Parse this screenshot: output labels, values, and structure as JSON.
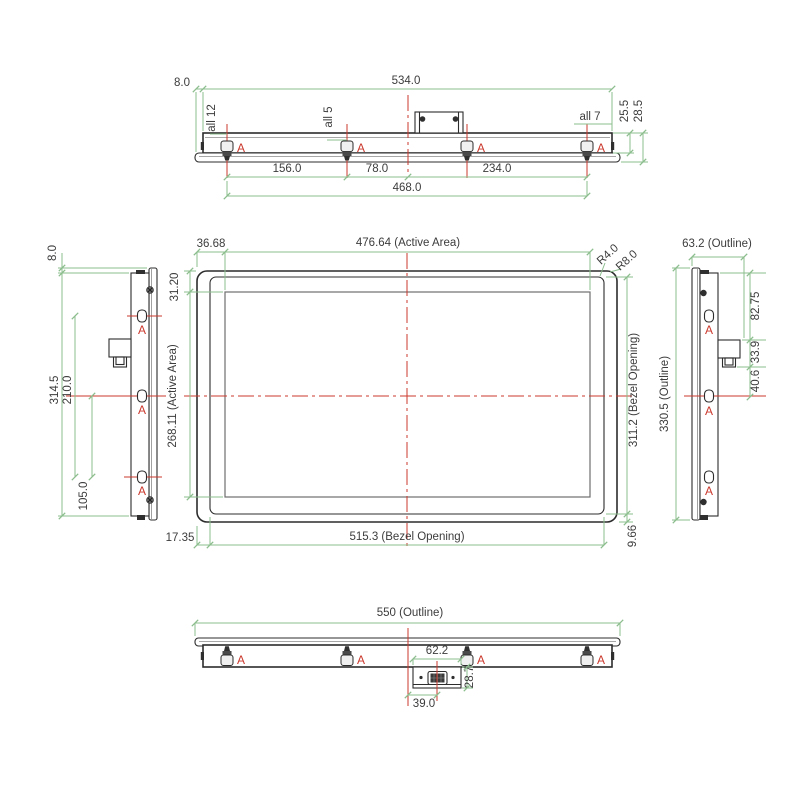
{
  "title": "Panel mechanical dimension drawing",
  "units": "mm",
  "datum": "A",
  "colors": {
    "dimension_line": "#8bbd8d",
    "centerline_and_datum": "#cb382c",
    "outline": "#2c2c2c",
    "active_area_line": "#6f6f6f",
    "background": "#ffffff"
  },
  "views": {
    "top": {
      "offset": "8.0",
      "overall": "534.0",
      "holes_left": "all 12",
      "holes_mid": "all 5",
      "holes_right": "all 7",
      "depth_inner": "25.5",
      "depth_outer": "28.5",
      "pitch_1": "156.0",
      "pitch_2": "78.0",
      "pitch_3": "234.0",
      "pitch_total": "468.0"
    },
    "left": {
      "offset": "8.0",
      "overall": "314.5",
      "pitch_upper": "210.0",
      "pitch_lower": "105.0"
    },
    "front": {
      "margin_left": "36.68",
      "active_width": "476.64 (Active Area)",
      "radius_bezel": "R4.0",
      "radius_outline": "R8.0",
      "margin_top": "31.20",
      "active_height": "268.11 (Active Area)",
      "bezel_height": "311.2 (Bezel Opening)",
      "margin_bottom": "17.35",
      "bezel_width": "515.3 (Bezel Opening)",
      "bezel_to_edge": "9.66"
    },
    "right": {
      "depth": "63.2 (Outline)",
      "overall": "330.5 (Outline)",
      "conn_from_top": "82.75",
      "conn_height": "33.9",
      "conn_to_center": "40.6"
    },
    "bottom": {
      "overall": "550 (Outline)",
      "conn_width": "62.2",
      "conn_depth": "28.7",
      "conn_offset": "39.0"
    }
  }
}
